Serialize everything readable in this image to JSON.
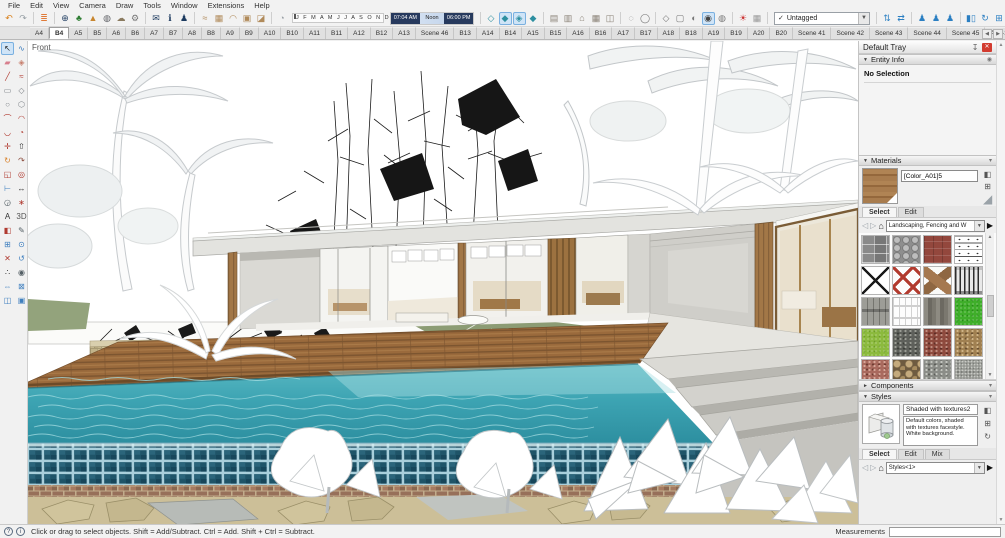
{
  "menu": {
    "items": [
      "File",
      "Edit",
      "View",
      "Camera",
      "Draw",
      "Tools",
      "Window",
      "Extensions",
      "Help"
    ]
  },
  "toolbar": {
    "icons_a": [
      {
        "name": "undo",
        "glyph": "↶",
        "color": "#d9821e"
      },
      {
        "name": "redo",
        "glyph": "↷",
        "color": "#98a0a6"
      },
      {
        "sep": true
      },
      {
        "name": "layers-stack",
        "glyph": "≣",
        "color": "#e07b39"
      },
      {
        "sep": true
      },
      {
        "name": "add-location",
        "glyph": "⊕",
        "color": "#1c3a5f"
      },
      {
        "name": "get-models-tree",
        "glyph": "♣",
        "color": "#2e7d32"
      },
      {
        "name": "add-terrain",
        "glyph": "▲",
        "color": "#c8862f"
      },
      {
        "name": "photo-textures",
        "glyph": "◍",
        "color": "#5f6166"
      },
      {
        "name": "cloud",
        "glyph": "☁",
        "color": "#8a7a5f"
      },
      {
        "name": "extension-settings-gear",
        "glyph": "⚙",
        "color": "#777777"
      },
      {
        "sep": true
      },
      {
        "name": "send-mail",
        "glyph": "✉",
        "color": "#1c3a5f"
      },
      {
        "name": "model-info",
        "glyph": "ℹ",
        "color": "#1c3a5f"
      },
      {
        "name": "user-account",
        "glyph": "♟",
        "color": "#1c3a5f"
      },
      {
        "sep": true
      },
      {
        "name": "sandbox-from-contours",
        "glyph": "≈",
        "color": "#b08a5a"
      },
      {
        "name": "sandbox-from-scratch",
        "glyph": "▦",
        "color": "#b08a5a"
      },
      {
        "name": "sandbox-smoove",
        "glyph": "◠",
        "color": "#b08a5a"
      },
      {
        "name": "sandbox-stamp",
        "glyph": "▣",
        "color": "#b08a5a"
      },
      {
        "name": "sandbox-drape",
        "glyph": "◪",
        "color": "#b08a5a"
      },
      {
        "sep": true
      },
      {
        "name": "soften-edges-sphere",
        "glyph": "◔",
        "color": "#9aa0a6"
      }
    ],
    "months_label": "J F M A M J J A S O N D",
    "time_start": "07:04 AM",
    "time_noon": "Noon",
    "time_end": "06:00 PM",
    "icons_b": [
      {
        "sep": true
      },
      {
        "name": "view-iso",
        "glyph": "◇",
        "color": "#2d8fa0"
      },
      {
        "name": "view-top",
        "glyph": "◆",
        "color": "#2d8fa0",
        "active": true
      },
      {
        "name": "view-front",
        "glyph": "◈",
        "color": "#2d8fa0",
        "active": true
      },
      {
        "name": "view-right",
        "glyph": "◆",
        "color": "#2d8fa0"
      },
      {
        "sep": true
      },
      {
        "name": "share-model",
        "glyph": "▤",
        "color": "#8b8378"
      },
      {
        "name": "download-models",
        "glyph": "▥",
        "color": "#8b8378"
      },
      {
        "name": "home-view",
        "glyph": "⌂",
        "color": "#8b8378"
      },
      {
        "name": "print-scene",
        "glyph": "▦",
        "color": "#8b8378"
      },
      {
        "name": "export-image",
        "glyph": "◫",
        "color": "#8b8378"
      },
      {
        "sep": true
      },
      {
        "name": "style-xray",
        "glyph": "◌",
        "color": "#777777"
      },
      {
        "name": "style-back-edges",
        "glyph": "◯",
        "color": "#777777"
      },
      {
        "sep": true
      },
      {
        "name": "style-wireframe",
        "glyph": "◇",
        "color": "#777777"
      },
      {
        "name": "style-hidden-line",
        "glyph": "▢",
        "color": "#777777"
      },
      {
        "name": "style-shaded",
        "glyph": "◐",
        "color": "#777777"
      },
      {
        "name": "style-shaded-textures",
        "glyph": "◉",
        "color": "#444444",
        "active": true
      },
      {
        "name": "style-monochrome",
        "glyph": "◍",
        "color": "#777777"
      },
      {
        "sep": true
      },
      {
        "name": "shadows-toggle",
        "glyph": "☀",
        "color": "#cc3333"
      },
      {
        "name": "shadow-settings",
        "glyph": "▦",
        "color": "#999999"
      },
      {
        "sep": true
      }
    ],
    "tag_check": "✓",
    "tag_value": "Untagged",
    "icons_c": [
      {
        "sep": true
      },
      {
        "name": "flip-along",
        "glyph": "⇅",
        "color": "#2b7fc2"
      },
      {
        "name": "move-axes",
        "glyph": "⇄",
        "color": "#2b7fc2"
      },
      {
        "sep": true
      },
      {
        "name": "place-person-small",
        "glyph": "♟",
        "color": "#2b7fc2"
      },
      {
        "name": "place-person-medium",
        "glyph": "♟",
        "color": "#2b7fc2"
      },
      {
        "name": "place-person-large",
        "glyph": "♟",
        "color": "#2b7fc2"
      },
      {
        "sep": true
      },
      {
        "name": "component-stats",
        "glyph": "▮▯",
        "color": "#2b7fc2"
      },
      {
        "name": "component-sync",
        "glyph": "↻",
        "color": "#2b7fc2"
      },
      {
        "name": "component-grid",
        "glyph": "⊞",
        "color": "#2b7fc2"
      },
      {
        "sep": true
      },
      {
        "name": "toolbar-overflow",
        "glyph": "◨",
        "color": "#888888"
      }
    ]
  },
  "scene_tabs": {
    "tabs": [
      {
        "label": "A4"
      },
      {
        "label": "B4",
        "active": true
      },
      {
        "label": "A5"
      },
      {
        "label": "B5"
      },
      {
        "label": "A6"
      },
      {
        "label": "B6"
      },
      {
        "label": "A7"
      },
      {
        "label": "B7"
      },
      {
        "label": "A8"
      },
      {
        "label": "B8"
      },
      {
        "label": "A9"
      },
      {
        "label": "B9"
      },
      {
        "label": "A10"
      },
      {
        "label": "B10"
      },
      {
        "label": "A11"
      },
      {
        "label": "B11"
      },
      {
        "label": "A12"
      },
      {
        "label": "B12"
      },
      {
        "label": "A13"
      },
      {
        "label": "Scene 46"
      },
      {
        "label": "B13"
      },
      {
        "label": "A14"
      },
      {
        "label": "B14"
      },
      {
        "label": "A15"
      },
      {
        "label": "B15"
      },
      {
        "label": "A16"
      },
      {
        "label": "B16"
      },
      {
        "label": "A17"
      },
      {
        "label": "B17"
      },
      {
        "label": "A18"
      },
      {
        "label": "B18"
      },
      {
        "label": "A19"
      },
      {
        "label": "B19"
      },
      {
        "label": "A20"
      },
      {
        "label": "B20"
      },
      {
        "label": "Scene 41"
      },
      {
        "label": "Scene 42"
      },
      {
        "label": "Scene 43"
      },
      {
        "label": "Scene 44"
      },
      {
        "label": "Scene 45"
      },
      {
        "label": "A13-1"
      }
    ],
    "scroll_left": "◀",
    "scroll_right": "▶"
  },
  "left_toolbar": {
    "tools": [
      {
        "name": "select",
        "glyph": "↖",
        "color": "#1a1a1a",
        "active": true
      },
      {
        "name": "lasso",
        "glyph": "∿",
        "color": "#3f7fbf"
      },
      {
        "name": "eraser",
        "glyph": "▰",
        "color": "#d77f8d"
      },
      {
        "name": "make-component",
        "glyph": "◈",
        "color": "#c77f6d"
      },
      {
        "name": "line",
        "glyph": "╱",
        "color": "#b03a30"
      },
      {
        "name": "freehand",
        "glyph": "≈",
        "color": "#b03a30"
      },
      {
        "name": "rectangle",
        "glyph": "▭",
        "color": "#7d8287"
      },
      {
        "name": "rotated-rectangle",
        "glyph": "◇",
        "color": "#7d8287"
      },
      {
        "name": "circle",
        "glyph": "○",
        "color": "#7d8287"
      },
      {
        "name": "polygon",
        "glyph": "⬡",
        "color": "#7d8287"
      },
      {
        "name": "arc",
        "glyph": "⌒",
        "color": "#b03a30"
      },
      {
        "name": "two-point-arc",
        "glyph": "◠",
        "color": "#b03a30"
      },
      {
        "name": "three-point-arc",
        "glyph": "◡",
        "color": "#b03a30"
      },
      {
        "name": "pie",
        "glyph": "◔",
        "color": "#b03a30"
      },
      {
        "name": "move",
        "glyph": "✛",
        "color": "#b03a30"
      },
      {
        "name": "push-pull",
        "glyph": "⇧",
        "color": "#333333"
      },
      {
        "name": "rotate",
        "glyph": "↻",
        "color": "#d9822b"
      },
      {
        "name": "follow-me",
        "glyph": "↷",
        "color": "#8a4a3b"
      },
      {
        "name": "scale",
        "glyph": "◱",
        "color": "#b03a30"
      },
      {
        "name": "offset",
        "glyph": "◎",
        "color": "#b03a30"
      },
      {
        "name": "tape-measure",
        "glyph": "⊢",
        "color": "#3f7fbf"
      },
      {
        "name": "dimension",
        "glyph": "↔",
        "color": "#333333"
      },
      {
        "name": "protractor",
        "glyph": "◶",
        "color": "#556066"
      },
      {
        "name": "axes",
        "glyph": "∗",
        "color": "#b03a30"
      },
      {
        "name": "text",
        "glyph": "A",
        "color": "#333333"
      },
      {
        "name": "3d-text",
        "glyph": "3D",
        "color": "#555555"
      },
      {
        "name": "paint-bucket",
        "glyph": "◧",
        "color": "#b03a30"
      },
      {
        "name": "sample-paint",
        "glyph": "✎",
        "color": "#556066"
      },
      {
        "name": "zoom-window",
        "glyph": "⊞",
        "color": "#3f7fbf"
      },
      {
        "name": "zoom",
        "glyph": "⊙",
        "color": "#3f7fbf"
      },
      {
        "name": "position-camera",
        "glyph": "✕",
        "color": "#b03a30"
      },
      {
        "name": "orbit",
        "glyph": "↺",
        "color": "#3f7fbf"
      },
      {
        "name": "walk",
        "glyph": "∴",
        "color": "#333333"
      },
      {
        "name": "look-around",
        "glyph": "◉",
        "color": "#556066"
      },
      {
        "name": "pan",
        "glyph": "⇔",
        "color": "#3f7fbf"
      },
      {
        "name": "zoom-extents",
        "glyph": "⊠",
        "color": "#3f7fbf"
      },
      {
        "name": "section-plane",
        "glyph": "◫",
        "color": "#3f7fbf"
      },
      {
        "name": "section-display",
        "glyph": "▣",
        "color": "#3f7fbf"
      }
    ]
  },
  "viewport": {
    "view_label": "Front"
  },
  "tray": {
    "title": "Default Tray",
    "entity_info": {
      "title": "Entity Info",
      "status": "No Selection"
    },
    "materials": {
      "title": "Materials",
      "preview_name": "[Color_A01]5",
      "tabs": [
        {
          "label": "Select",
          "active": true
        },
        {
          "label": "Edit"
        }
      ],
      "collection": "Landscaping, Fencing and W",
      "swatches": [
        {
          "name": "pavers-gray"
        },
        {
          "name": "cobblestone"
        },
        {
          "name": "brick-red"
        },
        {
          "name": "barbed-wire"
        },
        {
          "name": "wire-fence"
        },
        {
          "name": "lattice-red"
        },
        {
          "name": "wood-cross"
        },
        {
          "name": "metal-fence"
        },
        {
          "name": "wood-gate"
        },
        {
          "name": "picket-fence"
        },
        {
          "name": "wood-weathered"
        },
        {
          "name": "grass-green"
        },
        {
          "name": "grass-light"
        },
        {
          "name": "gravel-dark"
        },
        {
          "name": "gravel-red"
        },
        {
          "name": "gravel-brown"
        },
        {
          "name": "gravel-pink"
        },
        {
          "name": "river-rock"
        },
        {
          "name": "gravel-gray"
        },
        {
          "name": "gravel-fine"
        },
        {
          "name": "sand"
        },
        {
          "name": "thatch"
        },
        {
          "name": "stone-gray"
        },
        {
          "name": "brick-path"
        }
      ]
    },
    "components": {
      "title": "Components"
    },
    "styles": {
      "title": "Styles",
      "name": "Shaded with textures2",
      "description": "Default colors, shaded with textures facestyle. White background.",
      "tabs": [
        {
          "label": "Select",
          "active": true
        },
        {
          "label": "Edit"
        },
        {
          "label": "Mix"
        }
      ],
      "collection": "Styles<1>"
    }
  },
  "status_bar": {
    "icons": [
      {
        "name": "help-circle",
        "glyph": "?"
      },
      {
        "name": "geo-info-circle",
        "glyph": "i"
      }
    ],
    "hint": "Click or drag to select objects. Shift = Add/Subtract. Ctrl = Add. Shift + Ctrl = Subtract.",
    "measurements_label": "Measurements"
  }
}
